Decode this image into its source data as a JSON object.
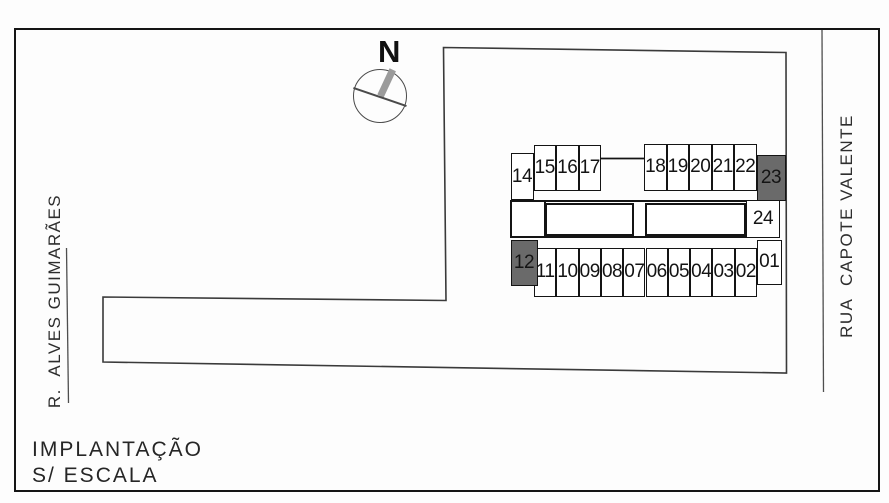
{
  "compass": {
    "label": "N"
  },
  "streets": {
    "left": "R.  ALVES GUIMARÃES",
    "right": "RUA  CAPOTE VALENTE"
  },
  "caption": {
    "line1": "IMPLANTAÇÃO",
    "line2": "S/ ESCALA"
  },
  "colors": {
    "outline": "#141414",
    "boundary_line": "#3a3a3a",
    "street_line": "#4f4f4f",
    "unit_fill": "#ffffff",
    "unit_dark_fill": "#6a6a6a",
    "needle_gray": "#9b9b9b",
    "chord_gray": "#4a4a4a"
  },
  "site_plan": {
    "boundary_points": [
      [
        443.5,
        47.5
      ],
      [
        786,
        52.5
      ],
      [
        786.5,
        373
      ],
      [
        103,
        362
      ],
      [
        103,
        297
      ],
      [
        446,
        300.5
      ]
    ],
    "street_line_left": {
      "x1": 66.5,
      "y1": 248,
      "x2": 68.5,
      "y2": 403
    },
    "street_line_right": {
      "x1": 822,
      "y1": 30,
      "x2": 823.5,
      "y2": 392
    },
    "connector_line": {
      "x1": 601,
      "y1": 158.5,
      "x2": 644,
      "y2": 158.5
    },
    "band": {
      "x": 510,
      "y": 199.5,
      "w": 270,
      "h": 38
    },
    "band_dividers": [
      {
        "x": 543.5,
        "y": 199.5,
        "h": 38
      }
    ],
    "buildings": [
      {
        "x": 544.5,
        "y": 202.5,
        "w": 89,
        "h": 33.5
      },
      {
        "x": 644.5,
        "y": 202.5,
        "w": 101,
        "h": 33.5
      }
    ],
    "units": [
      {
        "label": "14",
        "x": 510.5,
        "y": 153,
        "w": 23,
        "h": 47,
        "dark": false
      },
      {
        "label": "15",
        "x": 533.5,
        "y": 144.5,
        "w": 22.5,
        "h": 46.5,
        "dark": false
      },
      {
        "label": "16",
        "x": 556,
        "y": 144.5,
        "w": 22.5,
        "h": 46.5,
        "dark": false
      },
      {
        "label": "17",
        "x": 578.5,
        "y": 144.5,
        "w": 22.5,
        "h": 46.5,
        "dark": false
      },
      {
        "label": "18",
        "x": 644,
        "y": 143.5,
        "w": 22.5,
        "h": 47.5,
        "dark": false
      },
      {
        "label": "19",
        "x": 666.5,
        "y": 143.5,
        "w": 22.5,
        "h": 47.5,
        "dark": false
      },
      {
        "label": "20",
        "x": 689,
        "y": 143.5,
        "w": 22.5,
        "h": 47.5,
        "dark": false
      },
      {
        "label": "21",
        "x": 711.5,
        "y": 143.5,
        "w": 22.5,
        "h": 47.5,
        "dark": false
      },
      {
        "label": "22",
        "x": 734,
        "y": 143.5,
        "w": 22.5,
        "h": 47.5,
        "dark": false
      },
      {
        "label": "23",
        "x": 756.5,
        "y": 155,
        "w": 29,
        "h": 45.5,
        "dark": true
      },
      {
        "label": "24",
        "x": 746,
        "y": 199.5,
        "w": 34,
        "h": 38,
        "dark": false
      },
      {
        "label": "12",
        "x": 510.5,
        "y": 239.5,
        "w": 27,
        "h": 46,
        "dark": true
      },
      {
        "label": "11",
        "x": 534,
        "y": 247.5,
        "w": 22.3,
        "h": 49,
        "dark": false
      },
      {
        "label": "10",
        "x": 556.3,
        "y": 247.5,
        "w": 22.3,
        "h": 49,
        "dark": false
      },
      {
        "label": "09",
        "x": 578.6,
        "y": 247.5,
        "w": 22.3,
        "h": 49,
        "dark": false
      },
      {
        "label": "08",
        "x": 600.9,
        "y": 247.5,
        "w": 22.3,
        "h": 49,
        "dark": false
      },
      {
        "label": "07",
        "x": 623.2,
        "y": 247.5,
        "w": 22.3,
        "h": 49,
        "dark": false
      },
      {
        "label": "06",
        "x": 645.5,
        "y": 247.5,
        "w": 22.3,
        "h": 49,
        "dark": false
      },
      {
        "label": "05",
        "x": 667.8,
        "y": 247.5,
        "w": 22.3,
        "h": 49,
        "dark": false
      },
      {
        "label": "04",
        "x": 690.1,
        "y": 247.5,
        "w": 22.3,
        "h": 49,
        "dark": false
      },
      {
        "label": "03",
        "x": 712.4,
        "y": 247.5,
        "w": 22.3,
        "h": 49,
        "dark": false
      },
      {
        "label": "02",
        "x": 734.7,
        "y": 247.5,
        "w": 22.3,
        "h": 49,
        "dark": false
      },
      {
        "label": "01",
        "x": 757,
        "y": 239.5,
        "w": 24.5,
        "h": 45.5,
        "dark": false
      }
    ]
  }
}
